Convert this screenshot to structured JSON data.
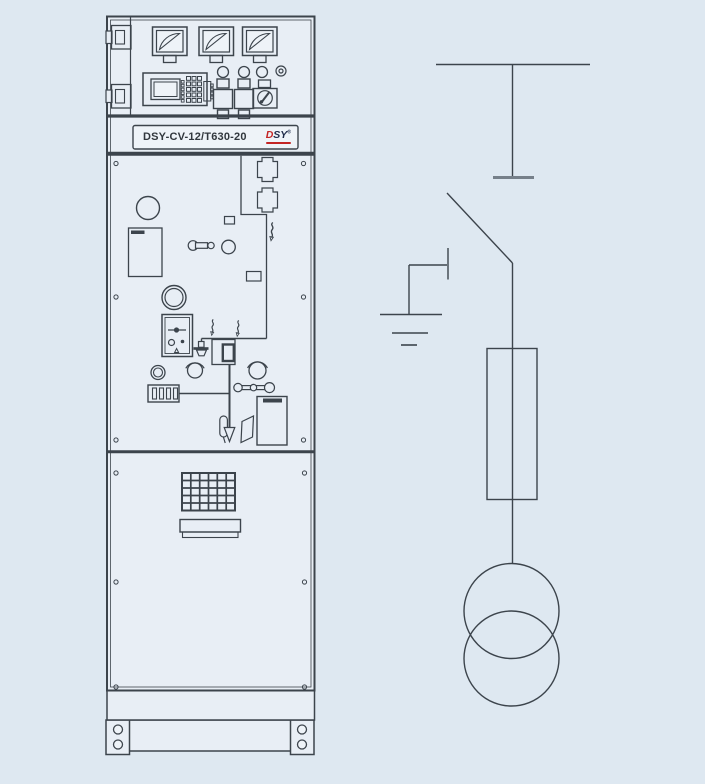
{
  "drawing": {
    "cabinet": {
      "model_label": "DSY-CV-12/T630-20",
      "logo": {
        "d": "D",
        "sy": "SY",
        "registered": "®"
      },
      "icons": {
        "analog-meter-icon": "square meter face with quarter-dial arc",
        "indicator-lamp-icon": "round lamp",
        "push-button-icon": "square push button with neck and tab",
        "key-switch-icon": "square switch with round key slot",
        "reset-indicator-icon": "double ring with dot",
        "hmi-relay-unit-icon": "screen with side buttons, keypad and connector",
        "hinge-icon": "door hinge block",
        "cable-connector-icon": "castle shaped bushing cover",
        "live-indicator-bolt-icon": "lightning zigzag arrow",
        "inspection-window-icon": "round window",
        "document-holder-icon": "rectangle with dark corner bar",
        "fuse-holder-icon": "two circles joined by bar",
        "operation-hole-icon": "circle with eyebrow arc",
        "mechanism-box-icon": "box with slider and dots",
        "earthing-clamp-icon": "bolt clamp",
        "junction-box-icon": "box with thick inner frame",
        "position-indicator-icon": "plate with four slots",
        "linkage-rod-icon": "rod with ball joints",
        "operation-arrow-icon": "hollow down arrow",
        "vent-grille-icon": "rectangular grid grille",
        "door-plate-icon": "long label plate",
        "screw-icon": "small screw circle",
        "bolt-hole-icon": "base bolt hole"
      }
    },
    "schematic": {
      "icons": {
        "busbar-icon": "horizontal busbar line",
        "isolating-contact-icon": "thick short contact bar",
        "disconnector-blade-icon": "diagonal switch blade",
        "earthing-switch-icon": "contact tick linked to earth",
        "earth-icon": "three stacked shrinking lines",
        "fuse-icon": "tall rectangle with through conductor",
        "transformer-icon": "two overlapping circles"
      }
    },
    "colors": {
      "background": "#dee8f1",
      "panel_fill": "#e8eef5",
      "face_fill": "#eef3f8",
      "line": "#3c444c",
      "contact_gray": "#76808a",
      "logo_red": "#c32424",
      "logo_navy": "#1f2b49",
      "label_text": "#31373d"
    }
  }
}
